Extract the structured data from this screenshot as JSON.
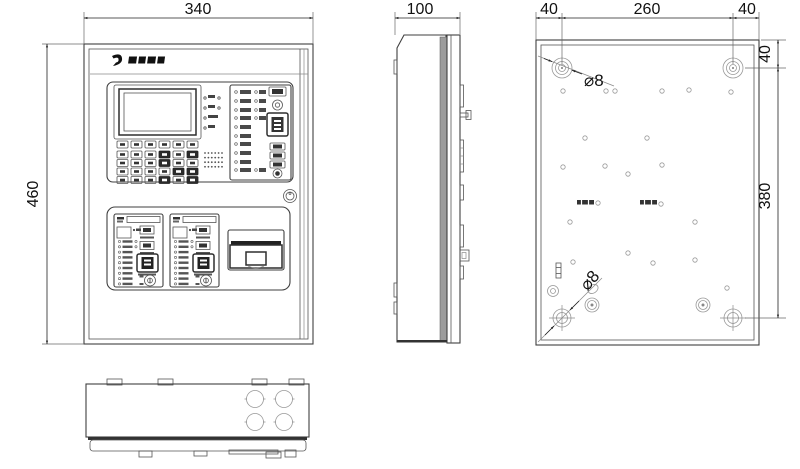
{
  "dimensions": {
    "front_width": "340",
    "front_height": "460",
    "side_depth": "100",
    "back_left_offset": "40",
    "back_hole_span": "260",
    "back_right_offset": "40",
    "back_top_offset": "40",
    "back_vertical_span": "380"
  },
  "callouts": {
    "top_mounting_hole": "⌀8",
    "bottom_mounting_hole": "⌀8"
  }
}
